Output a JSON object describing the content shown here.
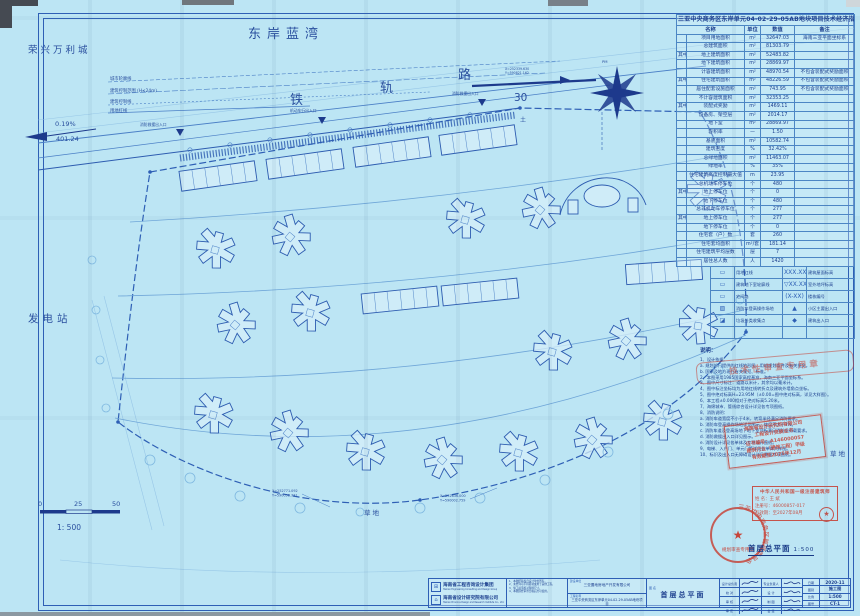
{
  "surroundings": {
    "neighbor_nw": "荣兴万利城",
    "bay": "东岸蓝湾",
    "power_station": "发电站",
    "grass_bottom": "草地",
    "grass_right": "草地",
    "soil": "土",
    "pm": "PM"
  },
  "road": {
    "name": [
      "铁",
      "轨",
      "路"
    ],
    "width_label": "30",
    "slope_grade": "0.19%",
    "slope_length": "401.24"
  },
  "control_lines": [
    "城市轮廓线",
    "建筑控制范围 (H≤24m)",
    "建筑控制线",
    "用地红线"
  ],
  "entrances": {
    "fire_west": "消防救援出入口",
    "vehicle": "机动车行出入口",
    "fire_mid": "消防救援出入口"
  },
  "coords_top": {
    "x": "X=252339.630",
    "y": "Y=590821.162"
  },
  "coords": [
    {
      "x": "X=252771.092",
      "y": "Y=590058.731"
    },
    {
      "x": "X=252836.000",
      "y": "Y=590002.759"
    }
  ],
  "scalebar": {
    "t0": "0",
    "t1": "25",
    "t2": "50",
    "ratio": "1: 500"
  },
  "plan_caption": {
    "title": "首层总平面",
    "scale": "1:500"
  },
  "indicators": {
    "title": "三亚中央商务区东岸单元04-02-29-05AB地块项目技术经济指标",
    "headers": {
      "name": "名称",
      "unit": "单位",
      "value": "数值",
      "remark": "备注"
    },
    "rows": [
      {
        "group": "",
        "name": "项目用地面积",
        "unit": "m²",
        "value": "32647.03",
        "remark": "海南三亚平面坐标系"
      },
      {
        "group": "",
        "name": "总建筑面积",
        "unit": "m²",
        "value": "81303.79",
        "remark": ""
      },
      {
        "group": "其中",
        "name": "地上建筑面积",
        "unit": "m²",
        "value": "52483.82",
        "remark": ""
      },
      {
        "group": "",
        "name": "地下建筑面积",
        "unit": "m²",
        "value": "28869.97",
        "remark": ""
      },
      {
        "group": "",
        "name": "计容建筑面积",
        "unit": "m²",
        "value": "48970.54",
        "remark": "不包含装配式奖励面积"
      },
      {
        "group": "其中",
        "name": "住宅建筑面积",
        "unit": "m²",
        "value": "48226.59",
        "remark": "不包含装配式奖励面积"
      },
      {
        "group": "",
        "name": "居住配套设施面积",
        "unit": "m²",
        "value": "743.95",
        "remark": "不包含装配式奖励面积"
      },
      {
        "group": "",
        "name": "不计容建筑面积",
        "unit": "m²",
        "value": "32353.25",
        "remark": ""
      },
      {
        "group": "其中",
        "name": "装配式奖励",
        "unit": "m²",
        "value": "1469.11",
        "remark": ""
      },
      {
        "group": "",
        "name": "设备房、架空层",
        "unit": "m²",
        "value": "2014.17",
        "remark": ""
      },
      {
        "group": "",
        "name": "地下室",
        "unit": "m²",
        "value": "28869.97",
        "remark": ""
      },
      {
        "group": "",
        "name": "容积率",
        "unit": "—",
        "value": "1.50",
        "remark": ""
      },
      {
        "group": "",
        "name": "基底面积",
        "unit": "m²",
        "value": "10582.74",
        "remark": ""
      },
      {
        "group": "",
        "name": "建筑密度",
        "unit": "%",
        "value": "32.42%",
        "remark": ""
      },
      {
        "group": "",
        "name": "总绿地面积",
        "unit": "m²",
        "value": "11463.07",
        "remark": ""
      },
      {
        "group": "",
        "name": "绿地率",
        "unit": "%",
        "value": "35%",
        "remark": ""
      },
      {
        "group": "",
        "name": "住宅建筑高度控制最大值",
        "unit": "m",
        "value": "23.95",
        "remark": ""
      },
      {
        "group": "",
        "name": "总机动车停车位",
        "unit": "个",
        "value": "480",
        "remark": ""
      },
      {
        "group": "其中",
        "name": "地上停车位",
        "unit": "个",
        "value": "0",
        "remark": ""
      },
      {
        "group": "",
        "name": "地下停车位",
        "unit": "个",
        "value": "480",
        "remark": ""
      },
      {
        "group": "",
        "name": "总非机动车停车位",
        "unit": "个",
        "value": "277",
        "remark": ""
      },
      {
        "group": "其中",
        "name": "地上停车位",
        "unit": "个",
        "value": "277",
        "remark": ""
      },
      {
        "group": "",
        "name": "地下停车位",
        "unit": "个",
        "value": "0",
        "remark": ""
      },
      {
        "group": "",
        "name": "住宅套（户）数",
        "unit": "套",
        "value": "260",
        "remark": ""
      },
      {
        "group": "",
        "name": "住宅套均面积",
        "unit": "m²/套",
        "value": "181.14",
        "remark": ""
      },
      {
        "group": "",
        "name": "住宅建筑平均层数",
        "unit": "层",
        "value": "7",
        "remark": ""
      },
      {
        "group": "",
        "name": "居住总人数",
        "unit": "人",
        "value": "1420",
        "remark": ""
      }
    ]
  },
  "legend": {
    "rows": [
      {
        "s1": "▭",
        "l1": "用地红线",
        "s2": "XXX.XX",
        "l2": "建筑屋面标高"
      },
      {
        "s1": "▭",
        "l1": "建筑地下室轮廓线",
        "s2": "▽XX.XX",
        "l2": "室外地坪标高"
      },
      {
        "s1": "▭",
        "l1": "宅间路",
        "s2": "(X-XX)",
        "l2": "楼栋编号"
      },
      {
        "s1": "▨",
        "l1": "消防车登高操作场地",
        "s2": "▲",
        "l2": "小区主要出入口"
      },
      {
        "s1": "◪",
        "l1": "垃圾分类收集点",
        "s2": "◆",
        "l2": "建筑出入口"
      },
      {
        "s1": "",
        "l1": "",
        "s2": "",
        "l2": ""
      }
    ]
  },
  "notes": {
    "title": "说明：",
    "lines": [
      "1、设计依据：",
      "a. 规划部门提供的红线地形图、用地规划条件及有关批文。",
      "b. 国家及地方现行有关规范、标准。",
      "2、本图采用1985国家高程基准，海南三亚平面坐标系。",
      "3、图中尺寸标注：道路以米计，其余均以毫米计。",
      "4、图中标注坐标均为用地红线转折点及建筑外墙角点坐标。",
      "5、图中绝对标高H=23.95M（±0.00=图中绝对标高，详见大样图）。",
      "6、本工程±0.000相对于绝对标高5.20米。",
      "7、海绵城市、管线综合设计详见各专项图纸。",
      "8、消防说明：",
      "a. 消防车道宽度不小于4米，转弯半径满足消防要求。",
      "b. 消防车登高操作场地详见图示，坡度不大于3%。",
      "c. 消防车道及登高场地下地下室顶板满足消防车荷载要求。",
      "d. 消防救援出入口详见图示。",
      "e. 消防设计详见各单体及专项设计图纸。",
      "9、电梯、入户门、单元门等详见各单体大样图。",
      "10、标识及出入口无障碍设计详见景观专项图纸。"
    ]
  },
  "stamps": {
    "review": "技术性审查专用章",
    "cert": {
      "lines": [
        "海南省设计研究院有限公司",
        "工程设计资质证书",
        "证书编号：A146000057",
        "建筑行业（建筑工程）甲级",
        "有效期至2025年12月"
      ]
    },
    "architect": {
      "title": "中华人民共和国一级注册建筑师",
      "name_label": "姓 名：",
      "name": "王 斌",
      "no_label": "注册号：",
      "no": "46000857-017",
      "valid_label": "有效期：",
      "valid": "至2027年08月",
      "seal_glyph": "★"
    },
    "circle": {
      "ring": "三亚中央商务区管理委员会",
      "star": "★",
      "inner": "规划审查专用章"
    }
  },
  "titleblock": {
    "org1": {
      "name": "海南省工程咨询设计集团",
      "eng": "Hainan Engineering Consulting and Design Group",
      "logo": "⊞"
    },
    "org2": {
      "name": "海南省设计研究院有限公司",
      "eng": "Hainan Province Design and Research Institute Co., Ltd.",
      "logo": "⌂"
    },
    "notes_lines": [
      "1、本图纸版权归设计单位所有。",
      "2、未经许可不得复制或用于其他工程。",
      "3、施工前须核对现场尺寸。",
      "4、本图须经审查合格后方可使用。"
    ],
    "fields": [
      {
        "label": "建设单位",
        "value": "三亚置地房地产开发有限公司"
      },
      {
        "label": "工程名称",
        "value": "三亚中央商务区东岸单元04-02-29-05AB地块项目"
      }
    ],
    "drawing": {
      "label": "图 名",
      "value": "首层总平面"
    },
    "sign_rows": [
      [
        "设计总负责",
        "专业负责人"
      ],
      [
        "校  对",
        "设  计"
      ],
      [
        "审  核",
        "制  图"
      ],
      [
        "审  定",
        "会  签"
      ]
    ],
    "info_rows": [
      {
        "label": "日期",
        "value": "2020-11"
      },
      {
        "label": "图别",
        "value": "施工图"
      },
      {
        "label": "比例",
        "value": "1:500"
      },
      {
        "label": "图号",
        "value": "CT-1"
      }
    ]
  }
}
